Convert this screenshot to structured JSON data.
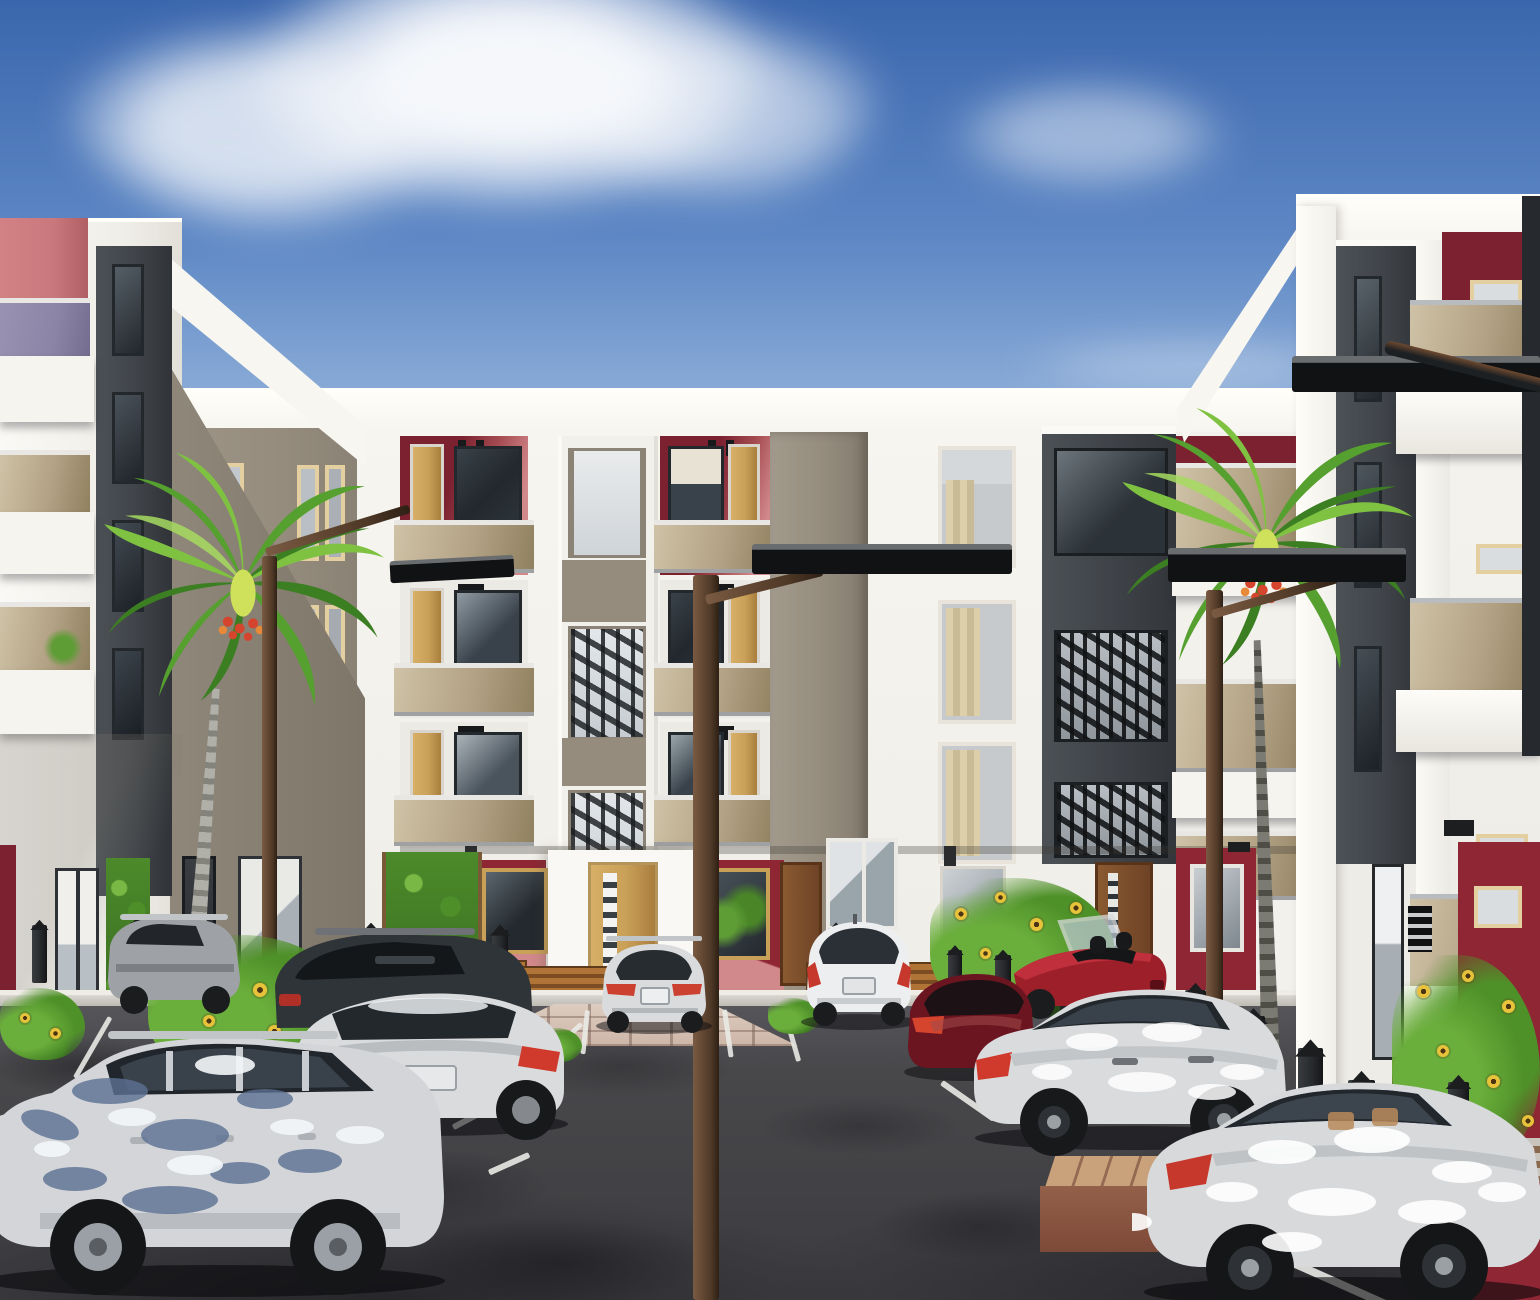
{
  "meta": {
    "title": "Residential courtyard 3D architectural rendering",
    "type": "exterior-visualization",
    "width": 1540,
    "height": 1300
  },
  "palette": {
    "sky-top": "#3a66ad",
    "sky-mid": "#5d87c4",
    "sky-low": "#8fafd9",
    "sky-horizon": "#b3c9e6",
    "cloud": "#f4f8fd",
    "wall-white": "#f6f4ef",
    "wall-bright": "#fdfcf9",
    "wall-shade": "#e3e0da",
    "wall-dim": "#cfccc5",
    "taupe": "#958c7e",
    "taupe-dark": "#847c6f",
    "charcoal": "#41454a",
    "charcoal-dark": "#33373b",
    "maroon": "#7c2130",
    "maroon-bright": "#8e2634",
    "rose": "#c9797d",
    "pink": "#d2898b",
    "wood": "#c9a058",
    "wood-dark": "#7a4a28",
    "glass-dark": "#22282d",
    "glass-light": "#cdd3d8",
    "bronze": "#b3a285",
    "bronze-light": "#cfc2a6",
    "bronze-dark": "#8f805f",
    "purple-glass": "#8b84a6",
    "frame-cream": "#e3cfa0",
    "curtain": "#d8c9a8",
    "asphalt": "#48484b",
    "asphalt-dark": "#323235",
    "sidewalk": "#d8d5cf",
    "paver": "#d3c0b2",
    "planter-top": "#c9a27c",
    "planter-front": "#7e4a38",
    "leaf-1": "#7fc242",
    "leaf-2": "#55a02e",
    "leaf-3": "#3c7f22",
    "leaf-hi": "#a6db60",
    "trunk": "#a3a39b",
    "trunk-dark": "#6b6b63",
    "flower-red": "#d5452e",
    "lamp-pole": "#5d4433",
    "lamp-dark": "#1d2023",
    "car-silver": "#d9dbdd",
    "car-dark": "#2f3438",
    "car-white": "#eceeef",
    "car-red": "#9c1f2a",
    "car-dred": "#6b1520",
    "tail-red": "#c6372c",
    "tail-orange": "#d96535",
    "tire": "#1a1c1e",
    "alloy": "#9ba0a5",
    "bench-wood": "#9a6231",
    "bollard": "#26282b",
    "sunflower": "#e8c23a",
    "sunflower-center": "#4a3414",
    "shrub": "#5e9c35"
  },
  "scene": {
    "sky": [
      "clear-blue-sky",
      "cumulus-cloud-top-left",
      "wispy-cloud-right"
    ],
    "buildings": [
      {
        "name": "left-apartment-block",
        "floors": 4,
        "features": [
          "stacked-balconies",
          "red-accent-panel",
          "purple-glass-balustrade",
          "bronze-glass-balustrades",
          "charcoal-window-strip"
        ]
      },
      {
        "name": "central-apartment-block",
        "floors": 4,
        "features": [
          "two-balcony-bays",
          "glass-stair-tower",
          "taupe-feature-column",
          "charcoal-stair-tower",
          "maroon-entrance-panels",
          "timber-doors",
          "tenant-benches"
        ]
      },
      {
        "name": "right-apartment-block",
        "floors": 4,
        "features": [
          "charcoal-recess",
          "projecting-bronze-balconies",
          "maroon-accent-panels",
          "entrance-steps"
        ]
      }
    ],
    "vehicles": [
      {
        "name": "silver-landcruiser-suv",
        "view": "side",
        "position": "foreground-left",
        "color": "silver-with-leaf-shadow"
      },
      {
        "name": "silver-crossover-left",
        "view": "rear-quarter",
        "position": "mid-left",
        "color": "silver"
      },
      {
        "name": "charcoal-suv",
        "view": "rear",
        "position": "behind-left-crossover",
        "color": "charcoal"
      },
      {
        "name": "gray-pickup",
        "view": "rear-quarter",
        "position": "far-left",
        "color": "gray"
      },
      {
        "name": "silver-sedan",
        "view": "rear",
        "position": "center",
        "color": "silver"
      },
      {
        "name": "white-suv",
        "view": "rear",
        "position": "center-right",
        "color": "white"
      },
      {
        "name": "dark-red-sedan",
        "view": "rear-quarter",
        "position": "right",
        "color": "dark-red"
      },
      {
        "name": "red-convertible",
        "view": "rear-quarter",
        "position": "right",
        "color": "red-open-top"
      },
      {
        "name": "silver-crossover-right",
        "view": "side",
        "position": "mid-right",
        "color": "silver-dappled"
      },
      {
        "name": "silver-suv-right",
        "view": "side",
        "position": "foreground-right",
        "color": "silver-dappled"
      }
    ],
    "vegetation": [
      "royal-palm-left",
      "royal-palm-right",
      "sunflower-beds",
      "climbing-vines",
      "shrubs"
    ],
    "street": [
      "solar-street-lamps",
      "black-bollards",
      "timber-benches",
      "white-parking-lines",
      "paved-walkway",
      "brick-planter"
    ]
  },
  "ground": {
    "bollards": [
      [
        32,
        925,
        58
      ],
      [
        130,
        922,
        56
      ],
      [
        363,
        928,
        60
      ],
      [
        492,
        930,
        62
      ],
      [
        828,
        928,
        62
      ],
      [
        948,
        950,
        55
      ],
      [
        995,
        955,
        60
      ],
      [
        1060,
        960,
        65
      ],
      [
        1118,
        968,
        72
      ],
      [
        1185,
        990,
        80
      ],
      [
        1242,
        1016,
        88
      ],
      [
        1298,
        1048,
        96
      ],
      [
        1348,
        1080,
        102
      ],
      [
        1448,
        1082,
        80
      ]
    ],
    "lines": [
      [
        455,
        1012,
        55,
        18,
        5
      ],
      [
        585,
        1010,
        44,
        6,
        5
      ],
      [
        722,
        1010,
        48,
        -8,
        5
      ],
      [
        782,
        1012,
        52,
        -16,
        5
      ],
      [
        487,
        1106,
        40,
        62,
        6
      ],
      [
        528,
        1152,
        44,
        66,
        6
      ],
      [
        580,
        1022,
        36,
        48,
        5
      ],
      [
        940,
        1085,
        64,
        -55,
        6
      ],
      [
        1165,
        1160,
        95,
        -62,
        7
      ],
      [
        1290,
        1266,
        120,
        -66,
        8
      ],
      [
        1432,
        1192,
        104,
        -64,
        8
      ],
      [
        30,
        1106,
        62,
        72,
        6
      ],
      [
        0,
        1138,
        44,
        78,
        7
      ],
      [
        108,
        1016,
        70,
        30,
        5
      ]
    ],
    "flower_clusters": [
      {
        "x": 148,
        "y": 935,
        "w": 205,
        "h": 150,
        "flowers": [
          [
            30,
            40,
            13
          ],
          [
            70,
            18,
            12
          ],
          [
            105,
            48,
            14
          ],
          [
            150,
            30,
            13
          ],
          [
            55,
            80,
            12
          ],
          [
            120,
            90,
            13
          ],
          [
            170,
            70,
            12
          ],
          [
            90,
            120,
            11
          ]
        ]
      },
      {
        "x": 930,
        "y": 878,
        "w": 185,
        "h": 140,
        "flowers": [
          [
            25,
            30,
            12
          ],
          [
            65,
            14,
            11
          ],
          [
            100,
            40,
            13
          ],
          [
            140,
            24,
            12
          ],
          [
            50,
            70,
            11
          ],
          [
            115,
            80,
            12
          ],
          [
            160,
            60,
            11
          ]
        ]
      },
      {
        "x": 1392,
        "y": 955,
        "w": 148,
        "h": 215,
        "flowers": [
          [
            25,
            30,
            13
          ],
          [
            70,
            15,
            12
          ],
          [
            110,
            45,
            13
          ],
          [
            45,
            90,
            12
          ],
          [
            95,
            120,
            13
          ],
          [
            130,
            160,
            12
          ],
          [
            60,
            170,
            12
          ]
        ]
      },
      {
        "x": 1180,
        "y": 1052,
        "w": 95,
        "h": 75,
        "flowers": [
          [
            22,
            22,
            11
          ],
          [
            55,
            14,
            11
          ],
          [
            70,
            44,
            10
          ]
        ]
      },
      {
        "x": 0,
        "y": 988,
        "w": 85,
        "h": 72,
        "flowers": [
          [
            20,
            25,
            10
          ],
          [
            50,
            40,
            11
          ]
        ]
      },
      {
        "x": 768,
        "y": 998,
        "w": 52,
        "h": 36,
        "flowers": []
      },
      {
        "x": 534,
        "y": 1028,
        "w": 48,
        "h": 34,
        "flowers": []
      }
    ]
  }
}
